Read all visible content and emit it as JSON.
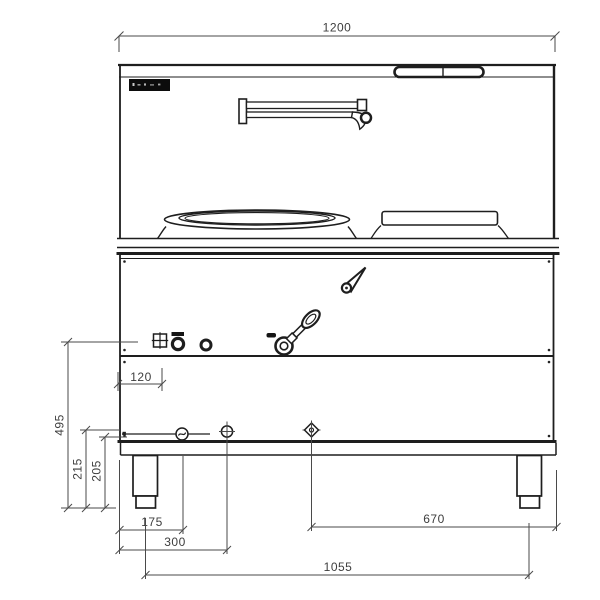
{
  "drawing": {
    "type": "technical-front-elevation",
    "subject": "commercial wok range with side burner, swing faucet and legs"
  },
  "dimensions": {
    "total_width": "1200",
    "left_height": "495",
    "leg_height_outer": "215",
    "leg_height_inner": "205",
    "igniter_offset": "120",
    "leg_offset": "175",
    "drain_offset": "300",
    "connection_offset": "670",
    "leg_spacing": "1055"
  },
  "colors": {
    "background": "#ffffff",
    "body_line": "#1e1e1e",
    "dimension_line": "#4a4a4a",
    "dimension_text": "#3d3d3d",
    "brand_badge": "#0c0c0c"
  }
}
